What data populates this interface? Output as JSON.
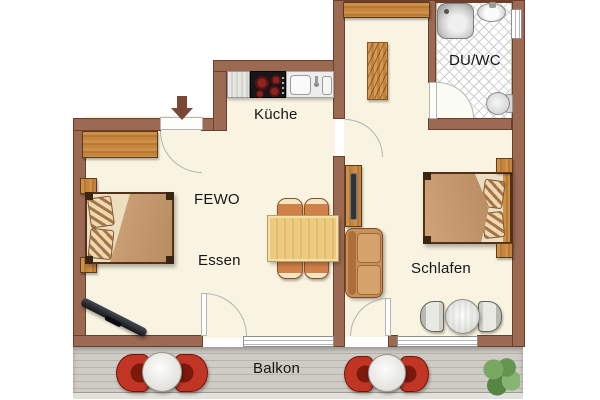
{
  "floorplan": {
    "rooms": {
      "kitchen": {
        "label": "Küche"
      },
      "bath": {
        "label": "DU/WC"
      },
      "living": {
        "label": "FEWO"
      },
      "dining": {
        "label": "Essen"
      },
      "bedroom": {
        "label": "Schlafen"
      },
      "balcony": {
        "label": "Balkon"
      }
    },
    "colors": {
      "wall": "#9c6953",
      "wall_edge": "#6e3e2c",
      "floor": "#f8f4e1",
      "tile_line": "#cdcdcd",
      "deck": "#cfccc5",
      "wood": "#c5853d",
      "balcony_chair_red": "#bf3322",
      "stove_burner": "#8c2422",
      "entrance_arrow": "#7c4836"
    },
    "furniture_icons": [
      "entrance-arrow",
      "wardrobe",
      "double-bed",
      "nightstand",
      "tv",
      "dining-table",
      "dining-chair",
      "kitchen-counter",
      "stove",
      "kitchen-sink",
      "tall-shelf",
      "tv-board",
      "sofa",
      "shower",
      "washbasin",
      "toilet",
      "round-table",
      "side-chair",
      "balcony-table",
      "balcony-chair",
      "plant"
    ]
  }
}
